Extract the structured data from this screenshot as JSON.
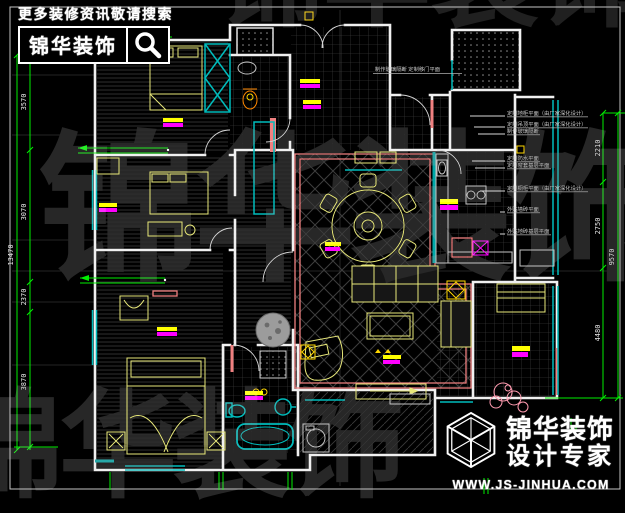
{
  "banner": {
    "tagline": "更多装修资讯敬请搜索",
    "brand": "锦华装饰",
    "search_icon": "magnifier"
  },
  "watermark": {
    "text": "锦华装饰"
  },
  "plan": {
    "annotations": {
      "top": "制作玻璃隔断 定制移门平面",
      "right": [
        "定制地柜平面（由厂家深化设计）",
        "定制吊顶平面（由厂家深化设计）",
        "制作玻璃隔断",
        "定制防水平面",
        "定制窗套基层平面",
        "定制橱柜平面（由厂家深化设计）",
        "外贴墙砖平面",
        "外贴地砖基层平面"
      ]
    },
    "dimensions": {
      "left_overall": "13470",
      "left": [
        "3570",
        "3070",
        "2370",
        "3870"
      ],
      "right": [
        "2210",
        "2750",
        "4480"
      ],
      "right_overall": "9570"
    },
    "colors": {
      "wall": "#f0f0f0",
      "window": "#00bcbc",
      "furniture": "#e8e87a",
      "accent_wall": "#f08080",
      "dimension_line": "#00ee00",
      "highlight_yellow": "#ffff00",
      "highlight_magenta": "#ff00ff"
    }
  },
  "footer": {
    "brand": "锦华装饰",
    "subtitle": "设计专家",
    "website": "WWW.JS-JINHUA.COM",
    "logo_icon": "wireframe-cube"
  }
}
